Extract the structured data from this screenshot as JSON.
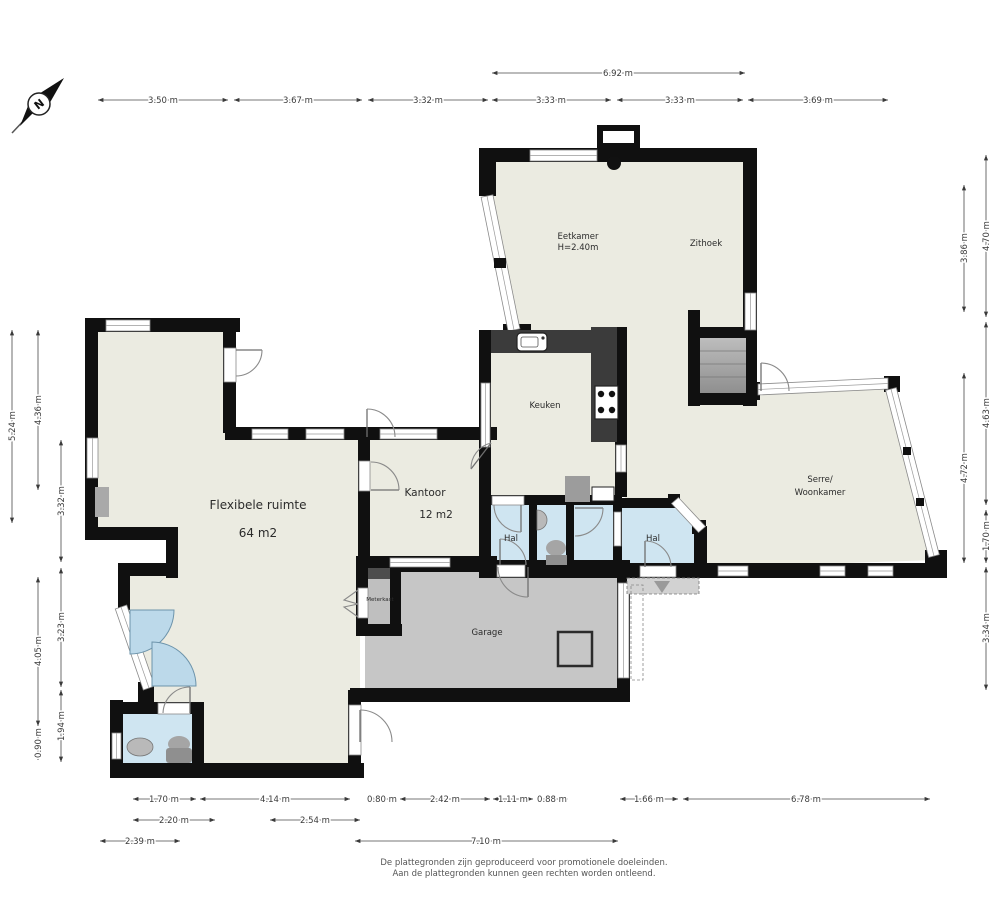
{
  "compass": {
    "letter": "N"
  },
  "rooms": {
    "flexibele_ruimte": {
      "label": "Flexibele ruimte",
      "area": "64 m2"
    },
    "kantoor": {
      "label": "Kantoor",
      "area": "12 m2"
    },
    "keuken": {
      "label": "Keuken"
    },
    "eetkamer": {
      "label": "Eetkamer",
      "ceiling": "H=2.40m"
    },
    "zithoek": {
      "label": "Zithoek"
    },
    "serre": {
      "label_line1": "Serre/",
      "label_line2": "Woonkamer"
    },
    "hal_left": {
      "label": "Hal"
    },
    "hal_right": {
      "label": "Hal"
    },
    "garage": {
      "label": "Garage"
    },
    "meterkast": {
      "label": "Meterkast"
    }
  },
  "dimensions": {
    "top_overall": "6.92 m",
    "top": [
      "3.50 m",
      "3.67 m",
      "3.32 m",
      "3.33 m",
      "3.33 m",
      "3.69 m"
    ],
    "right_inner": [
      "3.86 m",
      "4.72 m"
    ],
    "right_outer": [
      "4.70 m",
      "4.63 m",
      "1.70 m",
      "3.34 m"
    ],
    "left_col1": [
      "5.24 m"
    ],
    "left_col2": [
      "4.36 m",
      "4.05 m",
      "0.90 m"
    ],
    "left_col3": [
      "3.32 m",
      "3.23 m",
      "1.94 m"
    ],
    "bottom_row1": [
      "1.70 m",
      "4.14 m",
      "0.80 m",
      "2.42 m",
      "1.11 m",
      "0.88 m",
      "1.66 m",
      "6.78 m"
    ],
    "bottom_row2": [
      "2.20 m",
      "2.54 m"
    ],
    "bottom_row3": [
      "2.39 m",
      "7.10 m"
    ]
  },
  "footer": {
    "line1": "De plattegronden zijn geproduceerd voor promotionele doeleinden.",
    "line2": "Aan de plattegronden kunnen geen rechten worden ontleend."
  }
}
